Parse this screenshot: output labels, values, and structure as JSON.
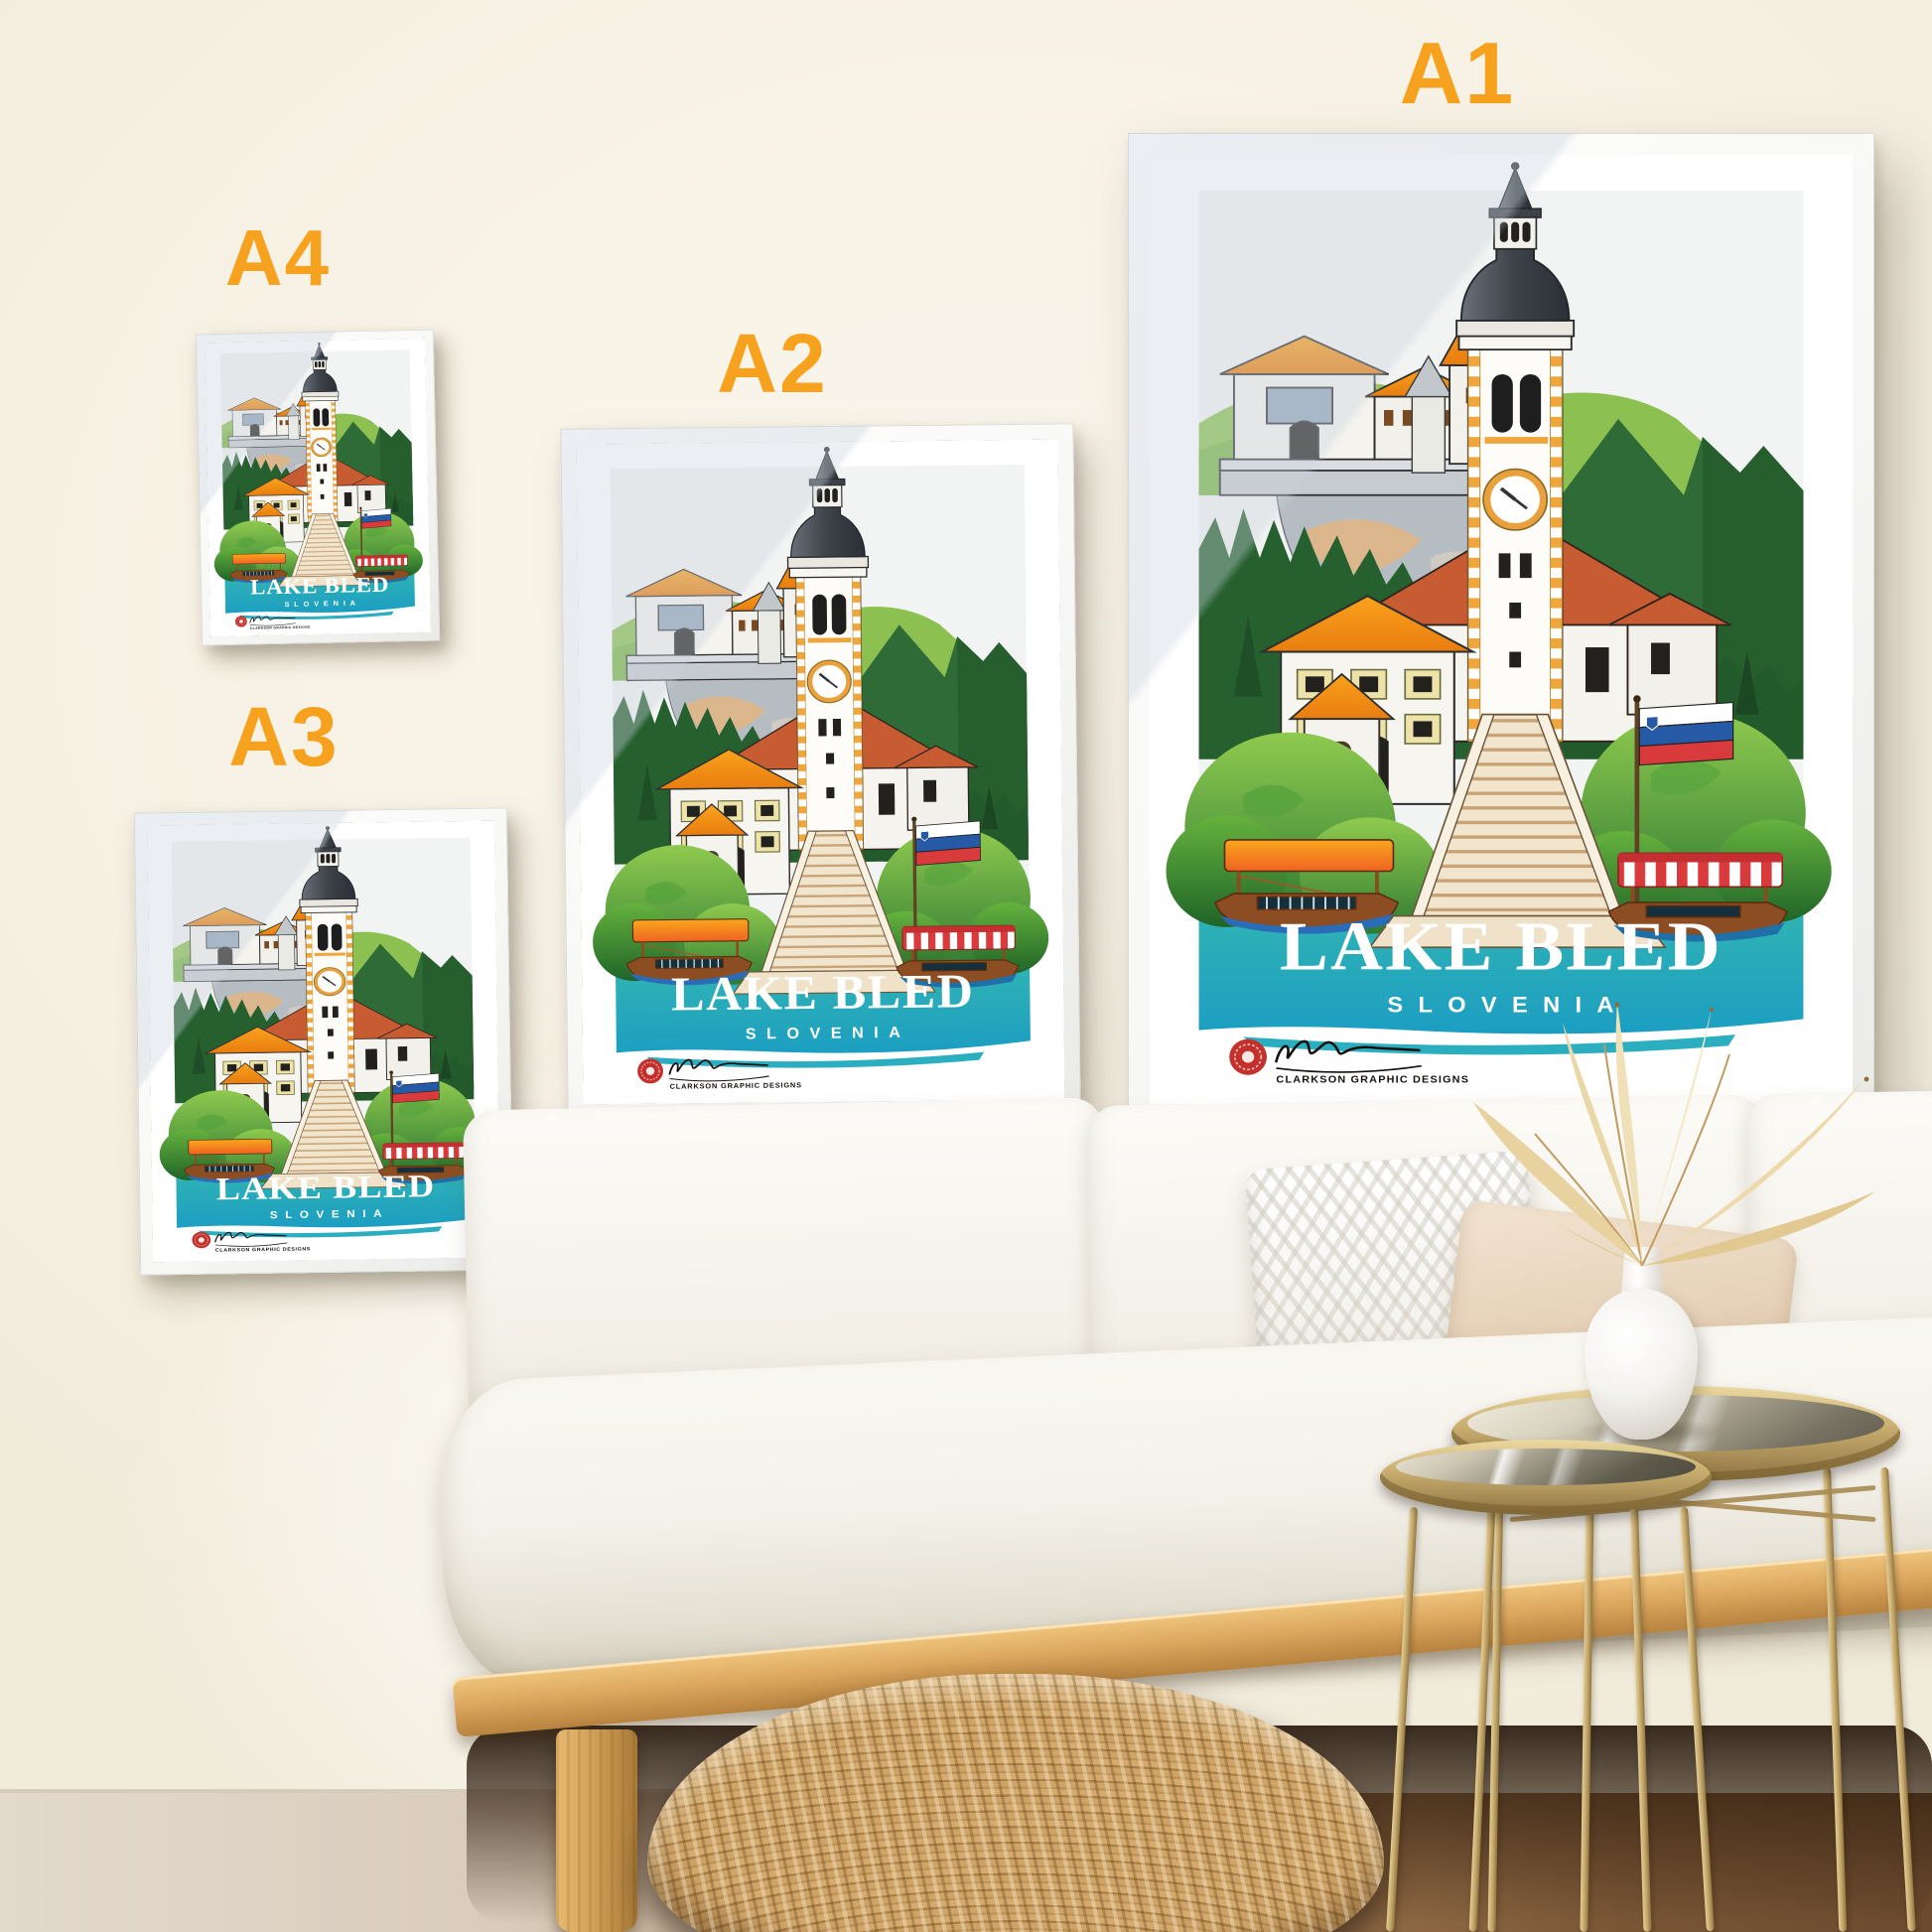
{
  "page": {
    "description": "Lake Bled travel poster print shown in four frame sizes on a living-room wall above a white sofa"
  },
  "size_labels": [
    {
      "id": "a4",
      "label": "A4"
    },
    {
      "id": "a3",
      "label": "A3"
    },
    {
      "id": "a2",
      "label": "A2"
    },
    {
      "id": "a1",
      "label": "A1"
    }
  ],
  "poster": {
    "title": "LAKE BLED",
    "subtitle": "SLOVENIA",
    "brand": "CLARKSON GRAPHIC DESIGNS"
  },
  "colors": {
    "label_orange": "#F6A21E",
    "wall_cream": "#F7F2E5",
    "poster_teal": "#2BB3AE",
    "frame_white": "#FFFFFF",
    "logo_red": "#C4302B",
    "flag_blue": "#2659A6",
    "flag_red": "#D93A3C"
  }
}
